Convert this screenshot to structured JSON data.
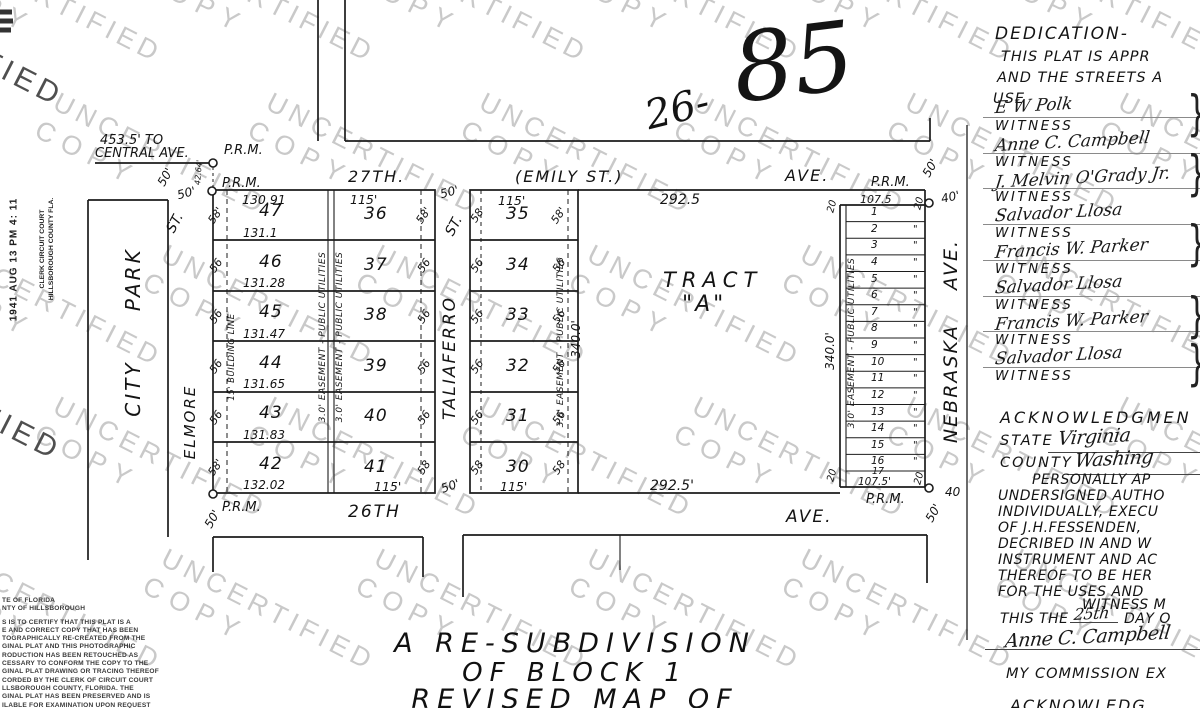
{
  "watermark": {
    "line1": "UNCERTIFIED",
    "line2": "COPY",
    "fragment": "FIED"
  },
  "case_number": {
    "prefix": "26-",
    "number": "85"
  },
  "clerk_stamp": {
    "date": "1941 AUG 13 PM 4: 11",
    "office1": "CLERK CIRCUIT COURT",
    "office2": "HILLSBOROUGH COUNTY FLA."
  },
  "reference_note": {
    "line1": "453.5' TO",
    "line2": "CENTRAL AVE."
  },
  "marker": {
    "prm": "P.R.M."
  },
  "streets": {
    "north_name": "27TH.",
    "north_alt": "(EMILY ST.)",
    "north_suffix": "AVE.",
    "south_name": "26TH",
    "south_suffix": "AVE.",
    "west_name": "ELMORE",
    "west_suffix": "ST.",
    "center_name": "TALIAFERRO",
    "center_suffix": "ST.",
    "east_name": "NEBRASKA AVE.",
    "park_name": "CITY PARK"
  },
  "widths": {
    "w50": "50'",
    "w50b": "50",
    "w40": "40'",
    "w40b": "40",
    "w20": "20",
    "d4264": "42.64'"
  },
  "west_block": {
    "top_length": "130.91",
    "col_a_lots": [
      {
        "n": "47",
        "len": "131.1"
      },
      {
        "n": "46",
        "len": "131.28"
      },
      {
        "n": "45",
        "len": "131.47"
      },
      {
        "n": "44",
        "len": "131.65"
      },
      {
        "n": "43",
        "len": "131.83"
      },
      {
        "n": "42",
        "len": "132.02"
      }
    ],
    "col_b_top": "115'",
    "col_b_lots": [
      {
        "n": "36"
      },
      {
        "n": "37"
      },
      {
        "n": "38"
      },
      {
        "n": "39"
      },
      {
        "n": "40"
      },
      {
        "n": "41"
      }
    ],
    "col_b_bottom": "115'",
    "west_ticks": [
      {
        "t": "58'"
      },
      {
        "t": "56"
      },
      {
        "t": "56"
      },
      {
        "t": "56"
      },
      {
        "t": "56"
      },
      {
        "t": "58'"
      }
    ],
    "east_ticks": [
      {
        "t": "58'"
      },
      {
        "t": "56"
      },
      {
        "t": "56"
      },
      {
        "t": "56"
      },
      {
        "t": "56"
      },
      {
        "t": "58"
      }
    ],
    "building_line_label": "15' BUILDING LINE",
    "easement_label": "3.0' EASEMENT - PUBLIC UTILITIES"
  },
  "center_block": {
    "top": "115'",
    "bottom": "115'",
    "lots": [
      {
        "n": "35"
      },
      {
        "n": "34"
      },
      {
        "n": "33"
      },
      {
        "n": "32"
      },
      {
        "n": "31"
      },
      {
        "n": "30"
      }
    ],
    "west_ticks": [
      {
        "t": "58"
      },
      {
        "t": "56"
      },
      {
        "t": "56"
      },
      {
        "t": "56"
      },
      {
        "t": "56"
      },
      {
        "t": "58"
      }
    ],
    "east_ticks": [
      {
        "t": "58'"
      },
      {
        "t": "56"
      },
      {
        "t": "56"
      },
      {
        "t": "56"
      },
      {
        "t": "56"
      },
      {
        "t": "58"
      }
    ],
    "easement_label": "3.0' EASEMENT - PUBLIC UTILITIES",
    "west_length": "340.0'"
  },
  "tract": {
    "label_1": "TRACT",
    "label_2": "\"A\"",
    "top_length": "292.5",
    "bottom_length": "292.5'",
    "east_length": "340.0'"
  },
  "strip": {
    "top_length": "107.5",
    "bottom_length": "107.5'",
    "last_lot": "17",
    "lots": [
      {
        "n": "1",
        "d": ""
      },
      {
        "n": "2",
        "d": "\""
      },
      {
        "n": "3",
        "d": "\""
      },
      {
        "n": "4",
        "d": "\""
      },
      {
        "n": "5",
        "d": "\""
      },
      {
        "n": "6",
        "d": "\""
      },
      {
        "n": "7",
        "d": "\""
      },
      {
        "n": "8",
        "d": "\""
      },
      {
        "n": "9",
        "d": "\""
      },
      {
        "n": "10",
        "d": "\""
      },
      {
        "n": "11",
        "d": "\""
      },
      {
        "n": "12",
        "d": "\""
      },
      {
        "n": "13",
        "d": "\""
      },
      {
        "n": "14",
        "d": "\""
      },
      {
        "n": "15",
        "d": "\""
      },
      {
        "n": "16",
        "d": "\""
      }
    ],
    "easement_label": "3.0' EASEMENT - PUBLIC UTILITIES"
  },
  "dedication": {
    "title": "DEDICATION-",
    "line1": "THIS PLAT IS APPR",
    "line2": "AND THE STREETS A",
    "line3": "USE",
    "witness_label": "WITNESS",
    "signatures": [
      {
        "name": "E W Polk"
      },
      {
        "name": "Anne C. Campbell"
      },
      {
        "name": "J. Melvin O'Grady Jr."
      },
      {
        "name": "Salvador Llosa"
      },
      {
        "name": "Francis W. Parker"
      },
      {
        "name": "Salvador Llosa"
      },
      {
        "name": "Francis W. Parker"
      },
      {
        "name": "Salvador Llosa"
      }
    ],
    "brace": "}"
  },
  "acknowledgment": {
    "title": "ACKNOWLEDGMEN",
    "state_label": "STATE",
    "state_value": "Virginia",
    "county_label": "COUNTY",
    "county_value": "Washing",
    "indent_line": "PERSONALLY AP",
    "lines": [
      {
        "t": "UNDERSIGNED AUTHO"
      },
      {
        "t": "INDIVIDUALLY, EXECU"
      },
      {
        "t": "OF J.H.FESSENDEN,"
      },
      {
        "t": "DECRIBED IN AND W"
      },
      {
        "t": "INSTRUMENT AND AC"
      },
      {
        "t": "THEREOF TO BE HER"
      },
      {
        "t": "FOR THE USES AND"
      }
    ],
    "witness_line": "WITNESS M",
    "date_pre": "THIS THE",
    "date_value": "25th",
    "date_post": "DAY O",
    "notary_signature": "Anne C. Campbell",
    "notary_title": "NOTARY PUBLIC",
    "commission_line": "MY COMMISSION EX",
    "partial_bottom": "ACKNOWLEDG"
  },
  "certification": {
    "header1": "TE OF FLORIDA",
    "header2": "NTY OF HILLSBOROUGH",
    "lines": [
      {
        "t": "S IS TO CERTIFY THAT THIS PLAT IS A"
      },
      {
        "t": "E AND CORRECT COPY THAT HAS BEEN"
      },
      {
        "t": "TOGRAPHICALLY RE-CREATED FROM THE"
      },
      {
        "t": "GINAL PLAT AND THIS PHOTOGRAPHIC"
      },
      {
        "t": "RODUCTION HAS BEEN RETOUCHED AS"
      },
      {
        "t": "CESSARY TO CONFORM THE COPY TO THE"
      },
      {
        "t": "GINAL PLAT DRAWING OR TRACING THEREOF"
      },
      {
        "t": "CORDED BY THE CLERK OF CIRCUIT COURT"
      },
      {
        "t": "LLSBOROUGH COUNTY, FLORIDA. THE"
      },
      {
        "t": "GINAL PLAT HAS BEEN PRESERVED AND IS"
      },
      {
        "t": "ILABLE FOR EXAMINATION UPON REQUEST"
      }
    ]
  },
  "title_block": {
    "line1": "A  RE-SUBDIVISION",
    "line2": "OF BLOCK 1",
    "line3": "REVISED MAP OF"
  }
}
